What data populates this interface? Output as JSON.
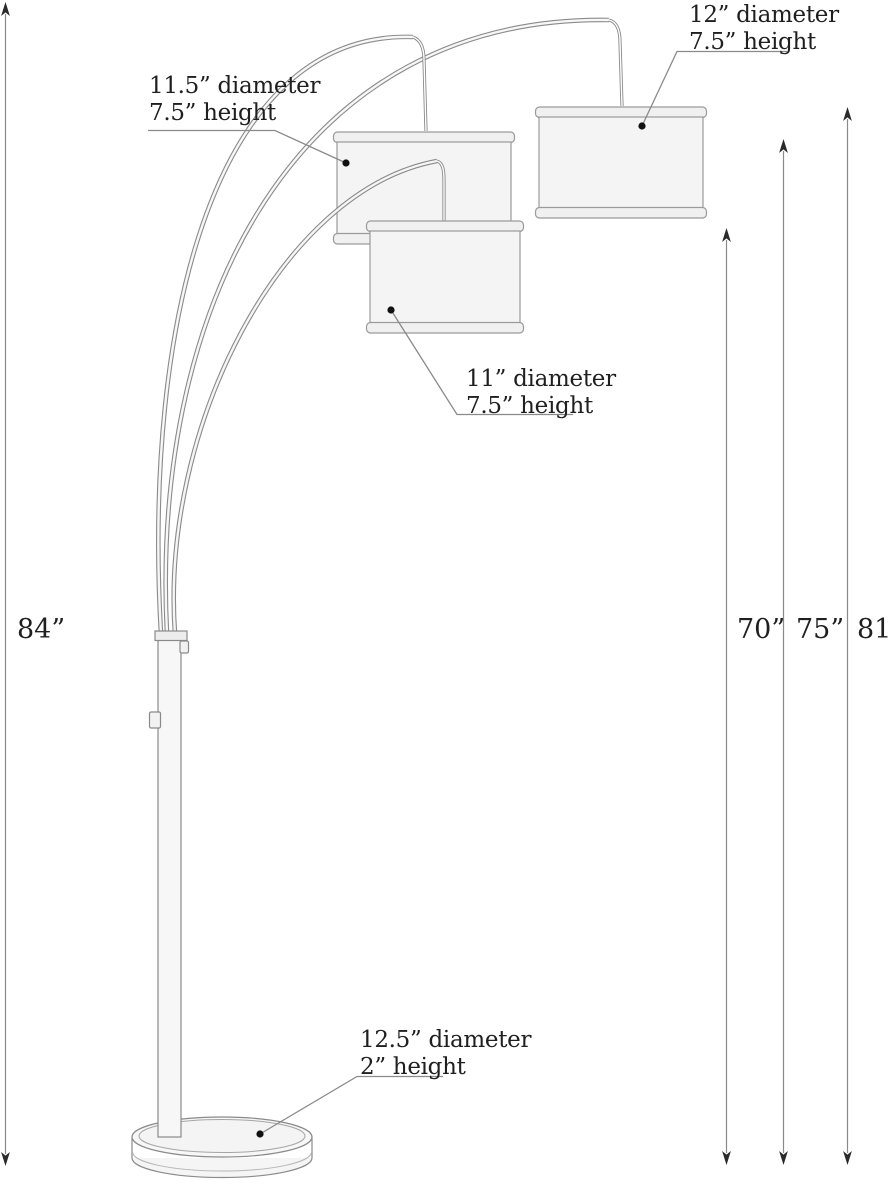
{
  "lamp": {
    "annotations": {
      "left_shade": {
        "line1": "11.5” diameter",
        "line2": "7.5” height"
      },
      "right_shade": {
        "line1": "12” diameter",
        "line2": "7.5” height"
      },
      "front_shade": {
        "line1": "11” diameter",
        "line2": "7.5” height"
      },
      "base": {
        "line1": "12.5” diameter",
        "line2": "2” height"
      }
    },
    "height_labels": {
      "overall": "84”",
      "inner": "70”",
      "middle": "75”",
      "outer": "81”"
    },
    "colors": {
      "line": "#8a8a8a",
      "text": "#1f1f1f",
      "shade_fill": "#f4f4f4",
      "background": "#ffffff"
    }
  }
}
